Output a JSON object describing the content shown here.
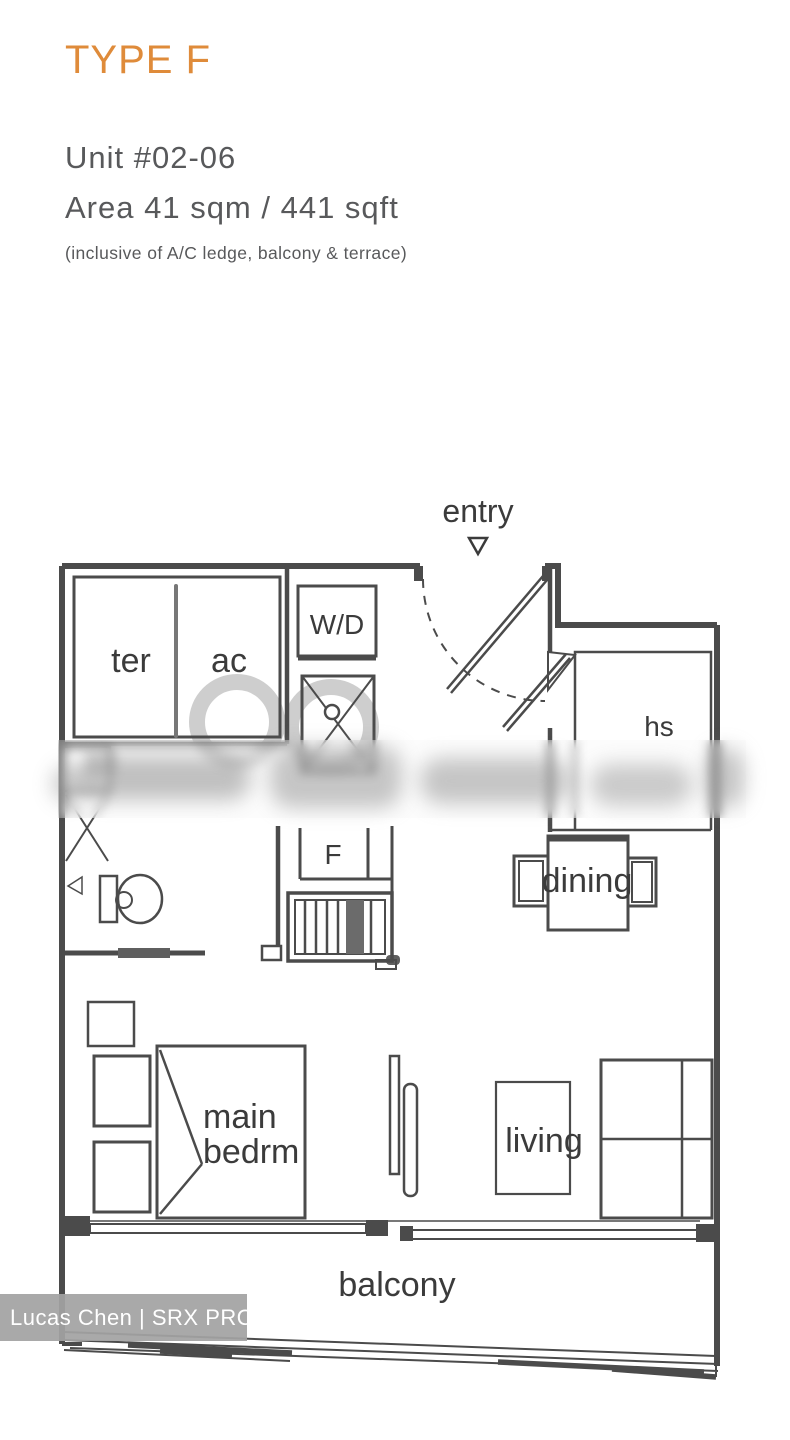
{
  "header": {
    "type_label": "TYPE F",
    "unit": "Unit #02-06",
    "area": "Area 41 sqm / 441 sqft",
    "note": "(inclusive of A/C ledge, balcony & terrace)"
  },
  "plan": {
    "entry": "entry",
    "terrace": "ter",
    "ac_ledge": "ac",
    "washer_dryer": "W/D",
    "household_shelter": "hs",
    "fridge": "F",
    "dining": "dining",
    "main_bedroom_line1": "main",
    "main_bedroom_line2": "bedrm",
    "living": "living",
    "balcony": "balcony"
  },
  "watermark": {
    "credit": "Lucas Chen | SRX PROPERTY"
  },
  "colors": {
    "accent": "#DF8B3A",
    "heading_text": "#58595B",
    "wall": "#4B4B4B",
    "watermark_ring": "#C9C9C9",
    "watermark_band_bg": "#A2A2A2",
    "watermark_band_text": "#FFFFFF"
  }
}
